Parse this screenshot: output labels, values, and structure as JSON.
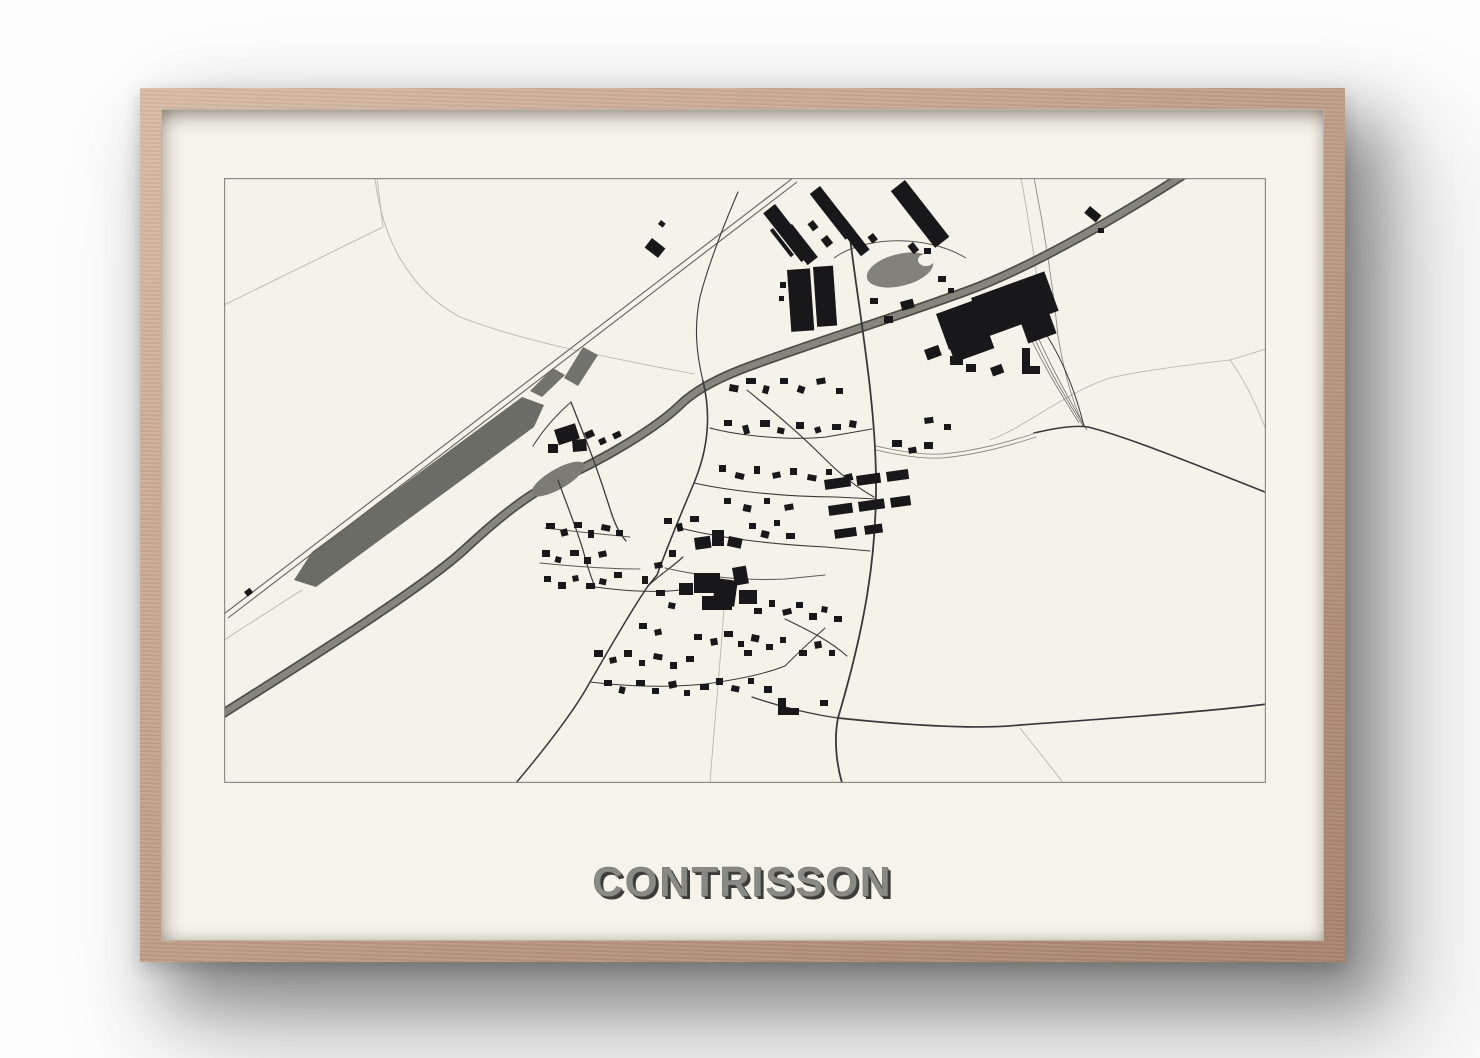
{
  "poster": {
    "title": "CONTRISSON"
  },
  "colors": {
    "wall": "#fdfdfd",
    "frame_wood": "#c1a08a",
    "frame_wood_light": "#d8bca6",
    "frame_wood_dark": "#a8846e",
    "mat": "#f6f4ea",
    "map_paper": "#f5f3e9",
    "map_border": "#8c8c85",
    "building_ink": "#18181a",
    "road_dark": "#38383a",
    "road_light": "#b4b4ab",
    "water_gray": "#85857e",
    "water_dark": "#4c4c47",
    "basin_gray": "#6c6c66",
    "title_fill": "#8a8a85",
    "title_shadow": "#3c3c38"
  }
}
